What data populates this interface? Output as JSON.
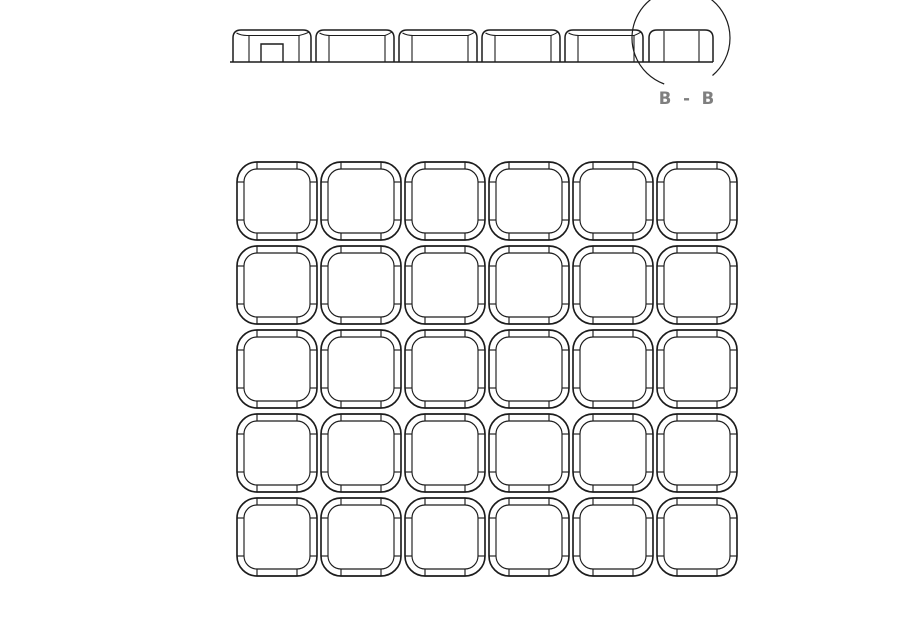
{
  "drawing": {
    "background": "#ffffff",
    "line_color": "#1c1c1c",
    "label_color": "#7f7f7f",
    "section": {
      "label": "B - B",
      "label_pos": {
        "x": 688,
        "y": 104
      },
      "baseline": {
        "x1": 230,
        "x2": 713,
        "y": 62
      },
      "top": 30,
      "corner_radius": 8,
      "inner_top_y": 35.5,
      "profiles": [
        {
          "x": 233,
          "w": 78,
          "type": "cap",
          "inner_left": 16,
          "inner_right": 12,
          "notch": {
            "left": 28,
            "right": 50,
            "top": 44
          }
        },
        {
          "x": 316,
          "w": 78,
          "type": "cap",
          "inner_left": 13,
          "inner_right": 9
        },
        {
          "x": 399,
          "w": 78,
          "type": "cap",
          "inner_left": 13,
          "inner_right": 9
        },
        {
          "x": 482,
          "w": 78,
          "type": "cap",
          "inner_left": 13,
          "inner_right": 9
        },
        {
          "x": 565,
          "w": 78,
          "type": "cap",
          "inner_left": 13,
          "inner_right": 9
        },
        {
          "x": 649,
          "w": 64,
          "type": "edge",
          "inner_left": 15,
          "inner_right": 14
        }
      ],
      "detail_circle": {
        "cx": 681,
        "cy": 38,
        "r": 49,
        "gap_start_deg": 50,
        "gap_end_deg": 110
      }
    },
    "grid": {
      "rows": 5,
      "cols": 6,
      "origin_x": 237,
      "origin_y": 162,
      "pitch_x": 84,
      "pitch_y": 84,
      "tile": {
        "width": 80,
        "height": 78,
        "outer_radius": 20,
        "inner_inset": 7,
        "inner_radius": 13,
        "tick_length": 7,
        "tick_offset": 20
      }
    }
  }
}
